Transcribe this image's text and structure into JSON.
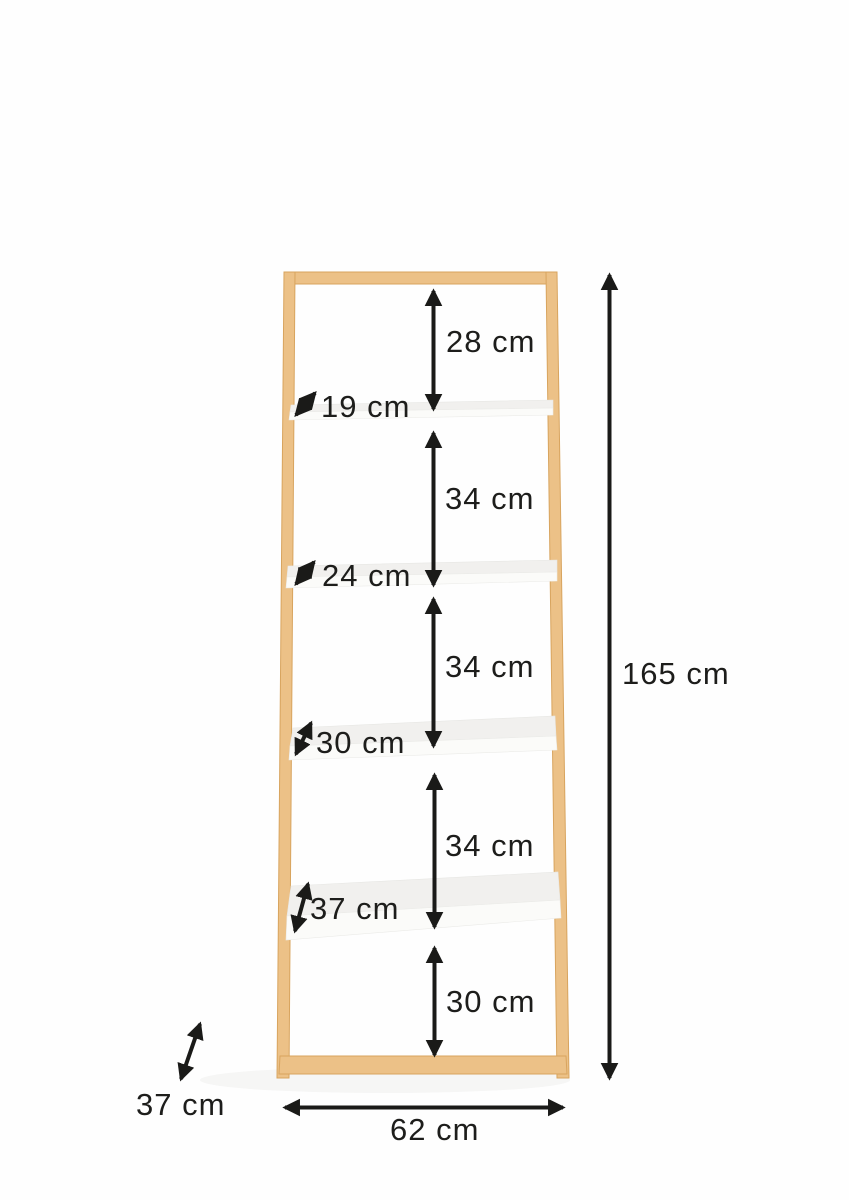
{
  "colors": {
    "wood": "#ecc187",
    "wood_edge": "#d8a45e",
    "shelf_top": "#f1f0ee",
    "shelf_front": "#fbfbf9",
    "shadow": "#efefec",
    "arrow": "#1a1a18",
    "text": "#1d1d1b",
    "background": "#fefefe"
  },
  "unit": "cm",
  "labels": {
    "top_gap": "28 cm",
    "shelf1_depth": "19 cm",
    "gap_1_2": "34 cm",
    "shelf2_depth": "24 cm",
    "gap_2_3": "34 cm",
    "shelf3_depth": "30 cm",
    "gap_3_4": "34 cm",
    "shelf4_depth": "37 cm",
    "bottom_gap": "30 cm",
    "total_height": "165 cm",
    "total_depth": "37 cm",
    "total_width": "62 cm"
  }
}
